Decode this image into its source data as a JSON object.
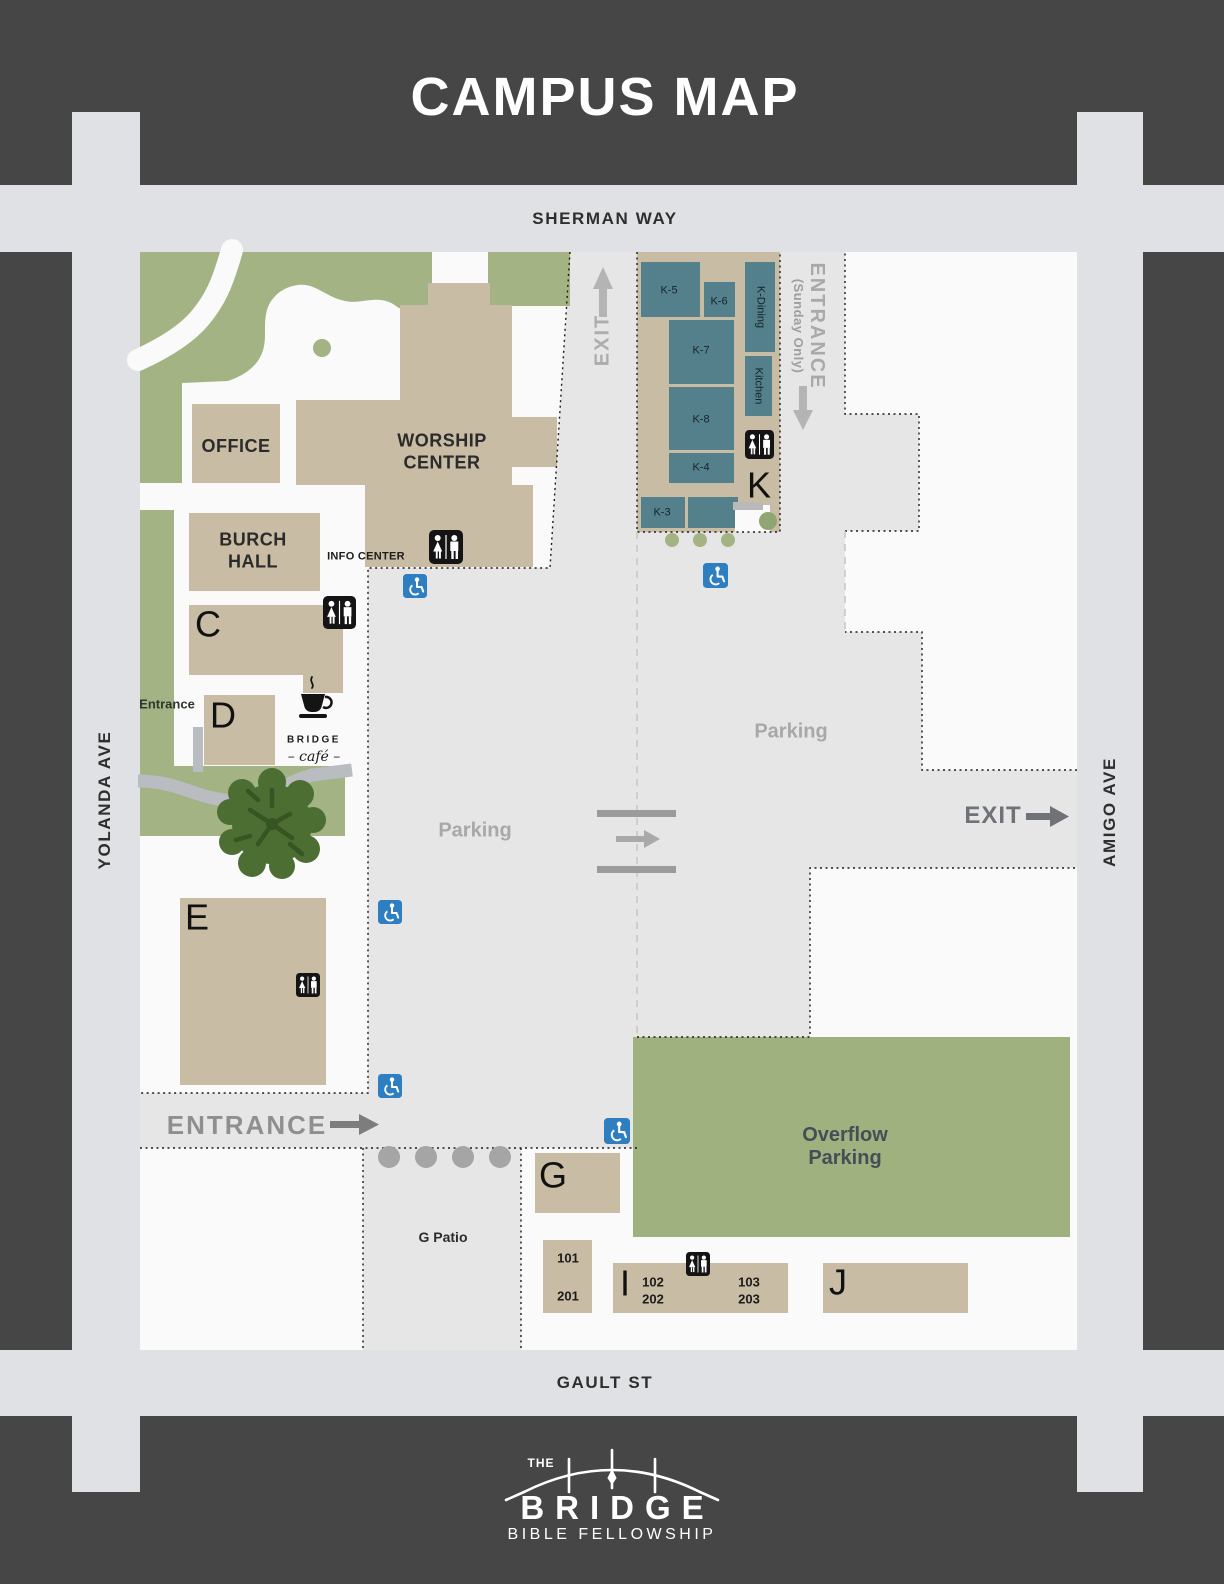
{
  "title": "CAMPUS MAP",
  "streets": {
    "top": "SHERMAN WAY",
    "bottom": "GAULT ST",
    "left": "YOLANDA AVE",
    "right": "AMIGO AVE"
  },
  "buildings": {
    "office": "OFFICE",
    "worship_center": "WORSHIP CENTER",
    "burch_hall": "BURCH HALL",
    "c": "C",
    "d": "D",
    "e": "E",
    "g": "G",
    "i": "I",
    "j": "J",
    "k": "K"
  },
  "k_rooms": {
    "k5": "K-5",
    "k6": "K-6",
    "k7": "K-7",
    "k8": "K-8",
    "k4": "K-4",
    "k3": "K-3",
    "dining": "K-Dining",
    "kitchen": "Kitchen"
  },
  "room_numbers": {
    "r101": "101",
    "r201": "201",
    "r102": "102",
    "r202": "202",
    "r103": "103",
    "r203": "203"
  },
  "labels": {
    "info_center": "INFO CENTER",
    "entrance_yolanda": "Entrance",
    "g_patio": "G Patio",
    "parking_central": "Parking",
    "parking_east": "Parking",
    "overflow": "Overflow Parking",
    "exit_north": "EXIT",
    "exit_east": "EXIT",
    "entrance_main": "ENTRANCE",
    "entrance_sunday": "ENTRANCE",
    "entrance_sunday_sub": "(Sunday Only)"
  },
  "cafe": {
    "name": "BRIDGE",
    "script": "– café –"
  },
  "logo": {
    "the": "THE",
    "name": "BRIDGE",
    "subtitle": "BIBLE  FELLOWSHIP"
  },
  "icons": {
    "restroom": "restroom-icon",
    "accessible": "wheelchair-accessible-icon",
    "tree": "tree-icon",
    "coffee": "coffee-cup-icon",
    "bridge_arc": "bridge-logo-icon"
  },
  "colors": {
    "background": "#464646",
    "road": "#e0e1e4",
    "campus": "#fafafa",
    "parking": "#e6e6e7",
    "building_tan": "#c8bca4",
    "room_teal": "#54808b",
    "landscape_green": "#a4b383",
    "overflow_green": "#9fb17e",
    "tree_green": "#4c6e33",
    "accessible_blue": "#2e7fc2",
    "icon_black": "#141414"
  }
}
